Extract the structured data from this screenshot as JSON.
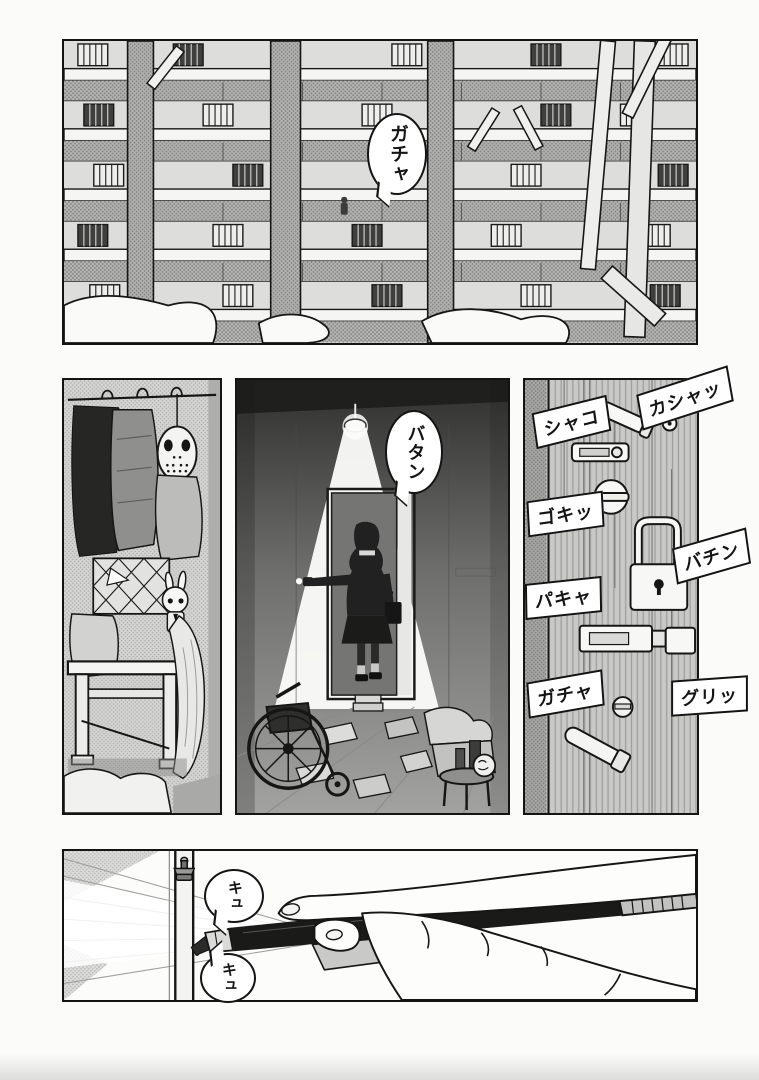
{
  "page": {
    "bg": "#fbfbf9",
    "ink": "#141414",
    "tone_light": "#d4d4d2",
    "tone_mid": "#c6c6c4",
    "tone_dark": "#8f8f8d"
  },
  "sfx": {
    "apartment_door": "ガチャ",
    "door_slam": "バタン",
    "locks": {
      "shako": "シャコ",
      "kasha": "カシャッ",
      "goki": "ゴキッ",
      "bachin": "バチン",
      "pakya": "パキャ",
      "gacha": "ガチャ",
      "guri": "グリッ"
    },
    "pen_squeak_1": "キュ",
    "pen_squeak_2": "キュ"
  }
}
